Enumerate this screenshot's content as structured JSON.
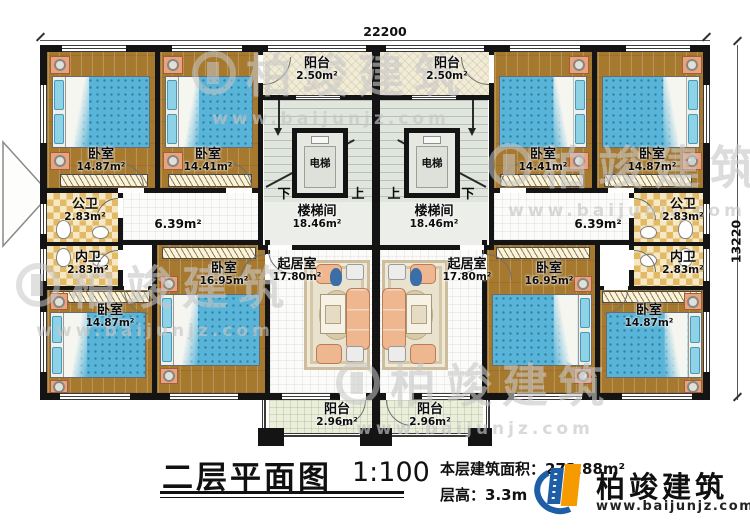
{
  "plan": {
    "dimensions": {
      "width_mm": "22200",
      "height_mm": "13220"
    },
    "stair": {
      "down": "下",
      "up": "上"
    },
    "rooms": {
      "bedroom_tl_outer": {
        "name": "卧室",
        "area": "14.87m²"
      },
      "bedroom_tl_inner": {
        "name": "卧室",
        "area": "14.41m²"
      },
      "bedroom_tr_inner": {
        "name": "卧室",
        "area": "14.41m²"
      },
      "bedroom_tr_outer": {
        "name": "卧室",
        "area": "14.87m²"
      },
      "balcony_top_left": {
        "name": "阳台",
        "area": "2.50m²"
      },
      "balcony_top_right": {
        "name": "阳台",
        "area": "2.50m²"
      },
      "stairwell_left": {
        "name": "楼梯间",
        "area": "18.46m²"
      },
      "stairwell_right": {
        "name": "楼梯间",
        "area": "18.46m²"
      },
      "elevator_left": {
        "name": "电梯"
      },
      "elevator_right": {
        "name": "电梯"
      },
      "hallway_left": {
        "area": "6.39m²"
      },
      "hallway_right": {
        "area": "6.39m²"
      },
      "public_bath_left": {
        "name": "公卫",
        "area": "2.83m²"
      },
      "public_bath_right": {
        "name": "公卫",
        "area": "2.83m²"
      },
      "ensuite_bath_left": {
        "name": "内卫",
        "area": "2.83m²"
      },
      "ensuite_bath_right": {
        "name": "内卫",
        "area": "2.83m²"
      },
      "bedroom_bl_outer": {
        "name": "卧室",
        "area": "14.87m²"
      },
      "bedroom_bl_inner": {
        "name": "卧室",
        "area": "16.95m²"
      },
      "bedroom_br_inner": {
        "name": "卧室",
        "area": "16.95m²"
      },
      "bedroom_br_outer": {
        "name": "卧室",
        "area": "14.87m²"
      },
      "living_left": {
        "name": "起居室",
        "area": "17.80m²"
      },
      "living_right": {
        "name": "起居室",
        "area": "17.80m²"
      },
      "balcony_bottom_left": {
        "name": "阳台",
        "area": "2.96m²"
      },
      "balcony_bottom_right": {
        "name": "阳台",
        "area": "2.96m²"
      }
    }
  },
  "titleblock": {
    "title": "二层平面图",
    "scale": "1:100",
    "area_label": "本层建筑面积：",
    "area_value": "273.88m²",
    "height_label": "层高：",
    "height_value": "3.3m"
  },
  "brand": {
    "name": "柏竣建筑",
    "url": "www.baijunjz.com"
  }
}
